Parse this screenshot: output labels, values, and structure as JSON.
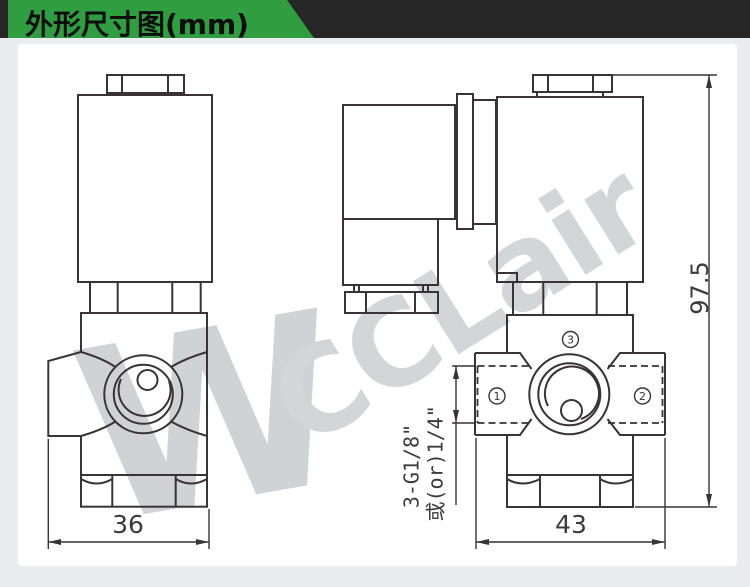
{
  "header": {
    "title": "外形尺寸图(mm)"
  },
  "watermark": {
    "logo": "W",
    "text": "CCLair"
  },
  "front_view": {
    "width_dim": "36"
  },
  "side_view": {
    "width_dim": "43",
    "height_dim": "97.5",
    "ports": {
      "n1": "1",
      "n2": "2",
      "n3": "3"
    },
    "thread_label": {
      "line1": "3-G1/8\"",
      "line2": "或(or)1/4\""
    }
  },
  "colors": {
    "accent_green": "#2f9e41",
    "header_bar": "#262626",
    "line": "#3a3234",
    "watermark": "#d3d6d8",
    "panel": "#ffffff",
    "page_bg": "#e9edf0"
  }
}
